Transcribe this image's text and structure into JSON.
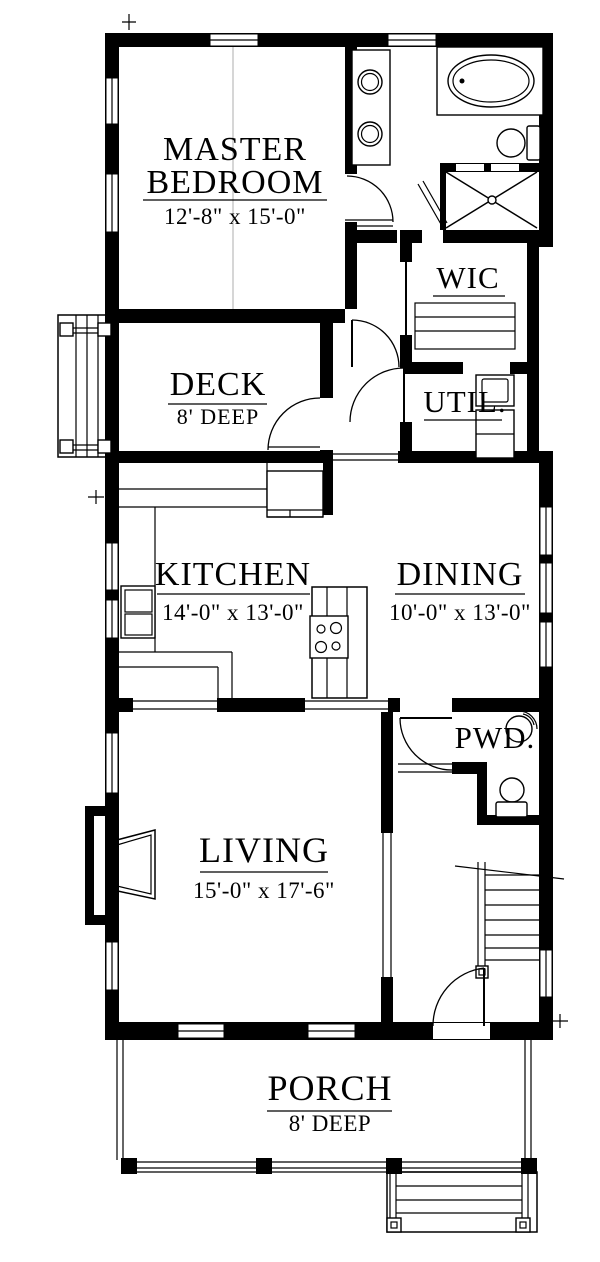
{
  "rooms": {
    "master": {
      "line1": "MASTER",
      "line2": "BEDROOM",
      "dims": "12'-8\" x 15'-0\""
    },
    "wic": {
      "label": "WIC"
    },
    "deck": {
      "label": "DECK",
      "depth": "8' DEEP"
    },
    "util": {
      "label": "UTIL."
    },
    "kitchen": {
      "label": "KITCHEN",
      "dims": "14'-0\" x 13'-0\""
    },
    "dining": {
      "label": "DINING",
      "dims": "10'-0\" x 13'-0\""
    },
    "living": {
      "label": "LIVING",
      "dims": "15'-0\" x 17'-6\""
    },
    "pwd": {
      "label": "PWD."
    },
    "porch": {
      "label": "PORCH",
      "depth": "8' DEEP"
    }
  },
  "colors": {
    "wall": "#000000",
    "background": "#ffffff"
  }
}
